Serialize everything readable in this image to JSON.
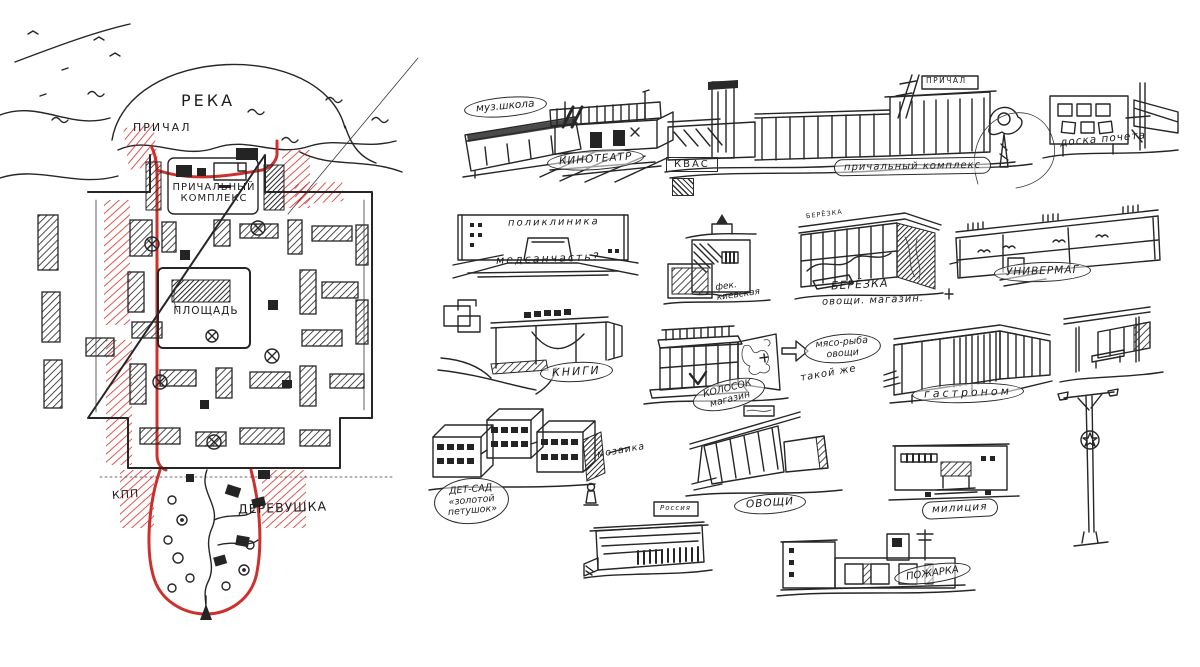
{
  "map": {
    "river": "РЕКА",
    "pier": "ПРИЧАЛ",
    "pier_complex": "ПРИЧАЛЬНЫЙ\nКОМПЛЕКС",
    "square": "ПЛОЩАДЬ",
    "checkpoint": "КПП",
    "village": "ДЕРЕВУШКА"
  },
  "colors": {
    "ink": "#262626",
    "route_red": "#c9201d"
  },
  "sketches": {
    "music_school": {
      "label": "муз.школа"
    },
    "cinema": {
      "label": "КИНОТЕАТР"
    },
    "kvass": {
      "label": "КВАС"
    },
    "pier_complex": {
      "label": "причальный комплекс",
      "roof_sign": "ПРИЧАЛ"
    },
    "honor_board": {
      "label": "доска почета"
    },
    "polyclinic": {
      "facade_sign": "поликлиника",
      "note": "медсанчасть?"
    },
    "fek_kievskaya": {
      "label": "фек.\nкиевская"
    },
    "beryozka": {
      "roof_sign": "БЕРЁЗКА",
      "label": "БЕРЁЗКА",
      "sublabel": "овощи. магазин."
    },
    "univermag": {
      "label": "УНИВЕРМАГ"
    },
    "books": {
      "label": "КНИГИ"
    },
    "kolosok": {
      "label": "КОЛОСОК\nмагазин"
    },
    "meat_fish": {
      "note": "мясо-рыба\nовощи",
      "subnote": "такой же"
    },
    "gastronom": {
      "label": "гастроном"
    },
    "kindergarten": {
      "label": "ДЕТ-САД\n«золотой\nпетушок»"
    },
    "mosaic": {
      "label": "мозаика"
    },
    "ovoschi": {
      "label": "ОВОЩИ"
    },
    "militia": {
      "label": "милиция"
    },
    "rossiya": {
      "roof_sign": "Россия"
    },
    "fire_station": {
      "label": "ПОЖАРКА"
    }
  }
}
